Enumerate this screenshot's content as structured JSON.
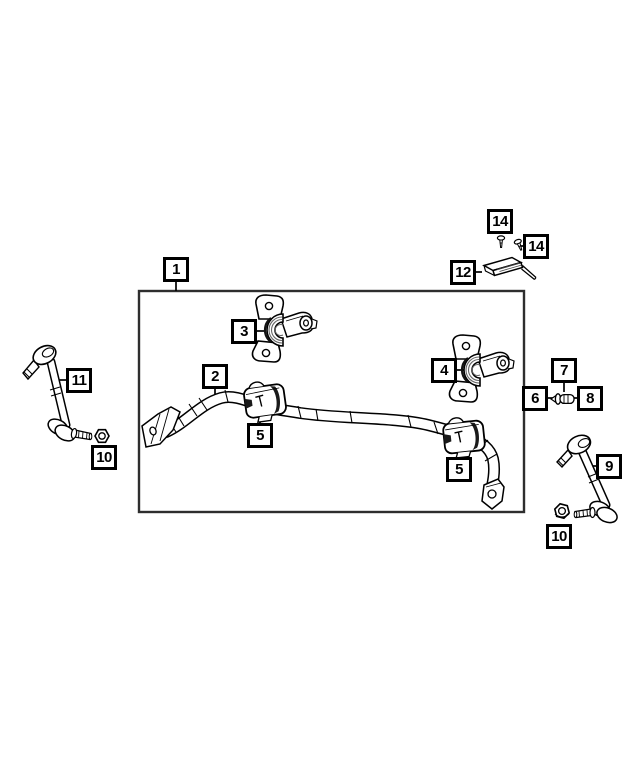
{
  "diagram": {
    "type": "exploded-parts-diagram",
    "colors": {
      "background": "#ffffff",
      "line": "#000000",
      "frame": "#2e2e2e",
      "callout_border": "#000000",
      "callout_text": "#000000",
      "shading": "#1a1a1a",
      "rib_gray": "#666666"
    },
    "callouts": [
      {
        "id": "callout-1",
        "label": "1"
      },
      {
        "id": "callout-2",
        "label": "2"
      },
      {
        "id": "callout-3",
        "label": "3"
      },
      {
        "id": "callout-4",
        "label": "4"
      },
      {
        "id": "callout-5a",
        "label": "5"
      },
      {
        "id": "callout-5b",
        "label": "5"
      },
      {
        "id": "callout-6",
        "label": "6"
      },
      {
        "id": "callout-7",
        "label": "7"
      },
      {
        "id": "callout-8",
        "label": "8"
      },
      {
        "id": "callout-9",
        "label": "9"
      },
      {
        "id": "callout-10a",
        "label": "10"
      },
      {
        "id": "callout-10b",
        "label": "10"
      },
      {
        "id": "callout-11",
        "label": "11"
      },
      {
        "id": "callout-12",
        "label": "12"
      },
      {
        "id": "callout-14a",
        "label": "14"
      },
      {
        "id": "callout-14b",
        "label": "14"
      }
    ]
  }
}
